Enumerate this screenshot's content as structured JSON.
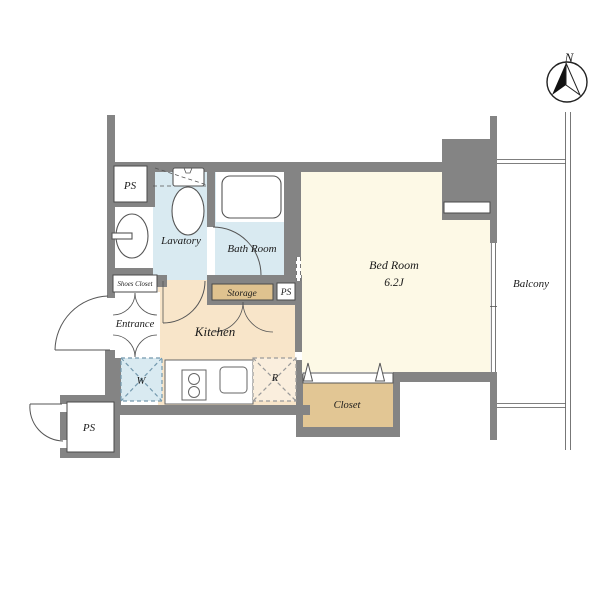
{
  "compass": {
    "north_label": "N"
  },
  "rooms": {
    "bed_room": {
      "label": "Bed Room",
      "size": "6.2J",
      "color": "#fdf9e6"
    },
    "kitchen": {
      "label": "Kitchen",
      "color": "#f8e5c9"
    },
    "lavatory": {
      "label": "Lavatory",
      "color": "#d9eaf1"
    },
    "bath_room": {
      "label": "Bath Room",
      "color": "#d9eaf1"
    },
    "entrance": {
      "label": "Entrance"
    },
    "balcony": {
      "label": "Balcony"
    },
    "closet": {
      "label": "Closet",
      "color": "#e2c694"
    },
    "storage": {
      "label": "Storage",
      "color": "#dfc28f"
    },
    "shoes_closet": {
      "label": "Shoes Closet"
    }
  },
  "fixtures": {
    "washer_label": "W",
    "fridge_label": "R",
    "ps_top_label": "PS",
    "ps_mid_label": "PS",
    "ps_bottom_label": "PS"
  },
  "colors": {
    "wall": "#848484",
    "outline": "#555555",
    "washer_bg": "#d9eaf1",
    "fridge_bg": "#faeedd"
  }
}
